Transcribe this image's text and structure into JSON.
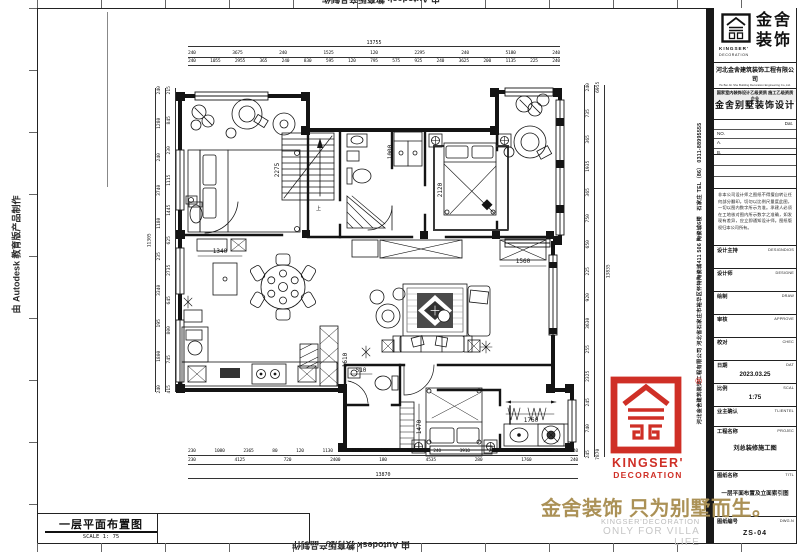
{
  "colors": {
    "slogan_gold": "#ab9156",
    "stamp_red": "#cf2f26"
  },
  "sheet": {
    "plan_label": "一层平面布置图",
    "plan_scale": "SCALE 1: 75"
  },
  "watermark": {
    "autodesk": "由 Autodesk 教育版产品制作"
  },
  "dims": {
    "top": {
      "total": "13755",
      "row1": [
        "240",
        "3675",
        "240",
        "1525",
        "120",
        "2295",
        "240",
        "5180",
        "240"
      ],
      "row2": [
        "240",
        "1055",
        "2955",
        "365",
        "240",
        "830",
        "595",
        "120",
        "795",
        "575",
        "925",
        "240",
        "3625",
        "200",
        "1135",
        "225",
        "240"
      ]
    },
    "bottom": {
      "row1": [
        "230",
        "1080",
        "2365",
        "80",
        "120",
        "1130",
        "1170",
        "100",
        "565",
        "240",
        "3910",
        "280",
        "1070",
        "690",
        "240"
      ],
      "row2": [
        "230",
        "4125",
        "720",
        "2400",
        "180",
        "4535",
        "280",
        "1760",
        "240"
      ],
      "total": "13870"
    },
    "left": {
      "total": "11305",
      "outer": [
        "240",
        "1280",
        "240",
        "3740",
        "1180",
        "235",
        "3340",
        "195",
        "1800",
        "240"
      ],
      "inner": [
        "215",
        "845",
        "230",
        "1115",
        "1445",
        "625",
        "2735",
        "645",
        "800",
        "745",
        "415"
      ]
    },
    "right": {
      "outer": [
        "240",
        "735",
        "365",
        "1935",
        "365",
        "750",
        "650",
        "225",
        "920",
        "3630",
        "255",
        "2325",
        "245",
        "740",
        "245"
      ],
      "inner": [
        "6955",
        "7870"
      ],
      "total": "13835"
    },
    "inline": {
      "stairs": "2275",
      "closet": "1000",
      "bed2": "2120",
      "island": "1340",
      "tv": "1560",
      "bath": "510",
      "wardrobe": "1470",
      "laundry": "1760",
      "cabinet": "1610",
      "up": "上"
    }
  },
  "titleblock": {
    "contact_top": "石家庄 TEL（86） 0311-88995555",
    "contact_bottom": "河北金舍建筑装饰工程有限公司  河北省石家庄市裕华区怀特陶瓷城411 506 陶瓷城6楼",
    "brand_cn_1": "金舍",
    "brand_cn_2": "装饰",
    "brand_en_1": "KINGSER'",
    "brand_en_2": "DECORATION",
    "company": "河北金舍建筑装饰工程有限公司",
    "company_en": "He Bei Jin She Building Decoration Engineering Co.,Ltd.",
    "qualification": "国家室内装饰设计乙级资质 施工乙级资质企业",
    "product": "金舍别墅装饰设计",
    "dat": "Dat.",
    "no": "NO.",
    "a": "A.",
    "b": "B.",
    "note": "非本公司设计师之图纸不得擅自转让任何部分翻印。切勿以比例尺量度此图，一切以图内数字所示为准。承建人必须在工地核对图内所示数字之准确，如发现有差异，应立即通知设计师。图纸版权归本公司所有。",
    "fields": [
      {
        "label": "设计主持",
        "en": "DESIGNDIOS",
        "value": ""
      },
      {
        "label": "设计师",
        "en": "DESIGNE",
        "value": ""
      },
      {
        "label": "绘制",
        "en": "DRAW",
        "value": ""
      },
      {
        "label": "审核",
        "en": "APPROVE",
        "value": ""
      },
      {
        "label": "校对",
        "en": "CHEC",
        "value": ""
      },
      {
        "label": "日期",
        "en": "DAT",
        "value": "2023.03.25"
      },
      {
        "label": "比例",
        "en": "SCAL",
        "value": "1:75"
      },
      {
        "label": "业主确认",
        "en": "TLIENTEL",
        "value": ""
      },
      {
        "label": "工程名称",
        "en": "PROJEC",
        "value": "刘总装修施工图"
      },
      {
        "label": "图纸名称",
        "en": "TITL",
        "value": "一层平面布置及立面索引图"
      },
      {
        "label": "图纸编号",
        "en": "DWG.N",
        "value": "ZS-04"
      }
    ]
  },
  "stamp": {
    "reg": "®",
    "en1": "KINGSER'",
    "en2": "DECORATION"
  },
  "slogan": {
    "cn": "金舍装饰 只为别墅而生。",
    "en1": "KINGSER'DECORATION",
    "en2": "ONLY FOR VILLA LIFE"
  }
}
